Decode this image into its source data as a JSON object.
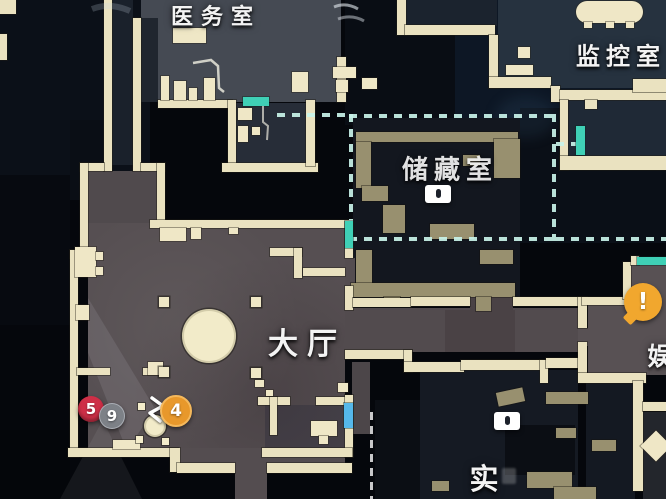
{
  "rooms": {
    "medical": {
      "label": "医务室"
    },
    "monitoring": {
      "label": "监控室"
    },
    "storage": {
      "label": "储藏室"
    },
    "hall": {
      "label": "大厅"
    },
    "entertainment": {
      "label": "娱"
    },
    "laboratory": {
      "label": "实"
    }
  },
  "markers": {
    "red_count": {
      "value": "5",
      "color": "#ce2f47"
    },
    "gray_count": {
      "value": "9",
      "color": "#7d8187"
    },
    "orange_count": {
      "value": "4",
      "color": "#e8982b"
    },
    "alert": {
      "value": "!",
      "color": "#f1a72e"
    }
  },
  "doors": {
    "teal": "#3fd0b6",
    "blue": "#55b8ea"
  },
  "boundary": {
    "dash_color": "#c8f3e9"
  },
  "palette": {
    "wall": "#eae2c0",
    "lit_floor": "#564f52",
    "dark_room": "#161b24",
    "background": "#05070c"
  }
}
